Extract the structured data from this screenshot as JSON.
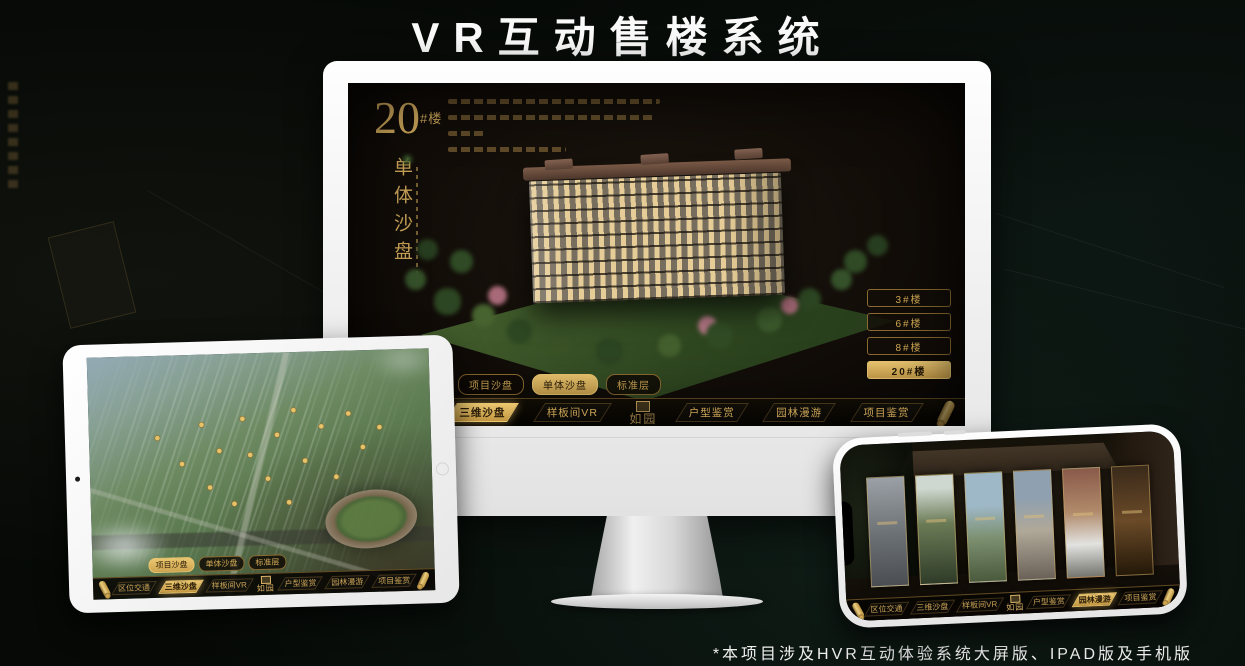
{
  "header": {
    "title": "VR互动售楼系统"
  },
  "footer": {
    "note": "*本项目涉及HVR互动体验系统大屏版、IPAD版及手机版"
  },
  "brand": {
    "logo": "如园"
  },
  "nav": {
    "items": [
      "区位交通",
      "三维沙盘",
      "样板间VR",
      "户型鉴赏",
      "园林漫游",
      "项目鉴赏"
    ],
    "sub_tabs": [
      "项目沙盘",
      "单体沙盘",
      "标准层"
    ]
  },
  "monitor": {
    "block_number": "20",
    "block_unit": "#楼",
    "block_subtitle": "单体沙盘",
    "active_sub_tab": "单体沙盘",
    "floor_buttons": [
      "3#楼",
      "6#楼",
      "8#楼",
      "20#楼"
    ],
    "active_floor": "20#楼",
    "active_nav_item": "三维沙盘"
  },
  "ipad": {
    "active_sub_tab": "项目沙盘",
    "active_nav_item": "三维沙盘"
  },
  "phone": {
    "active_nav_item": "园林漫游"
  },
  "colors": {
    "gold": "#d2a955",
    "gold_active": "#e3bd66",
    "screen_bg": "#14100a"
  }
}
